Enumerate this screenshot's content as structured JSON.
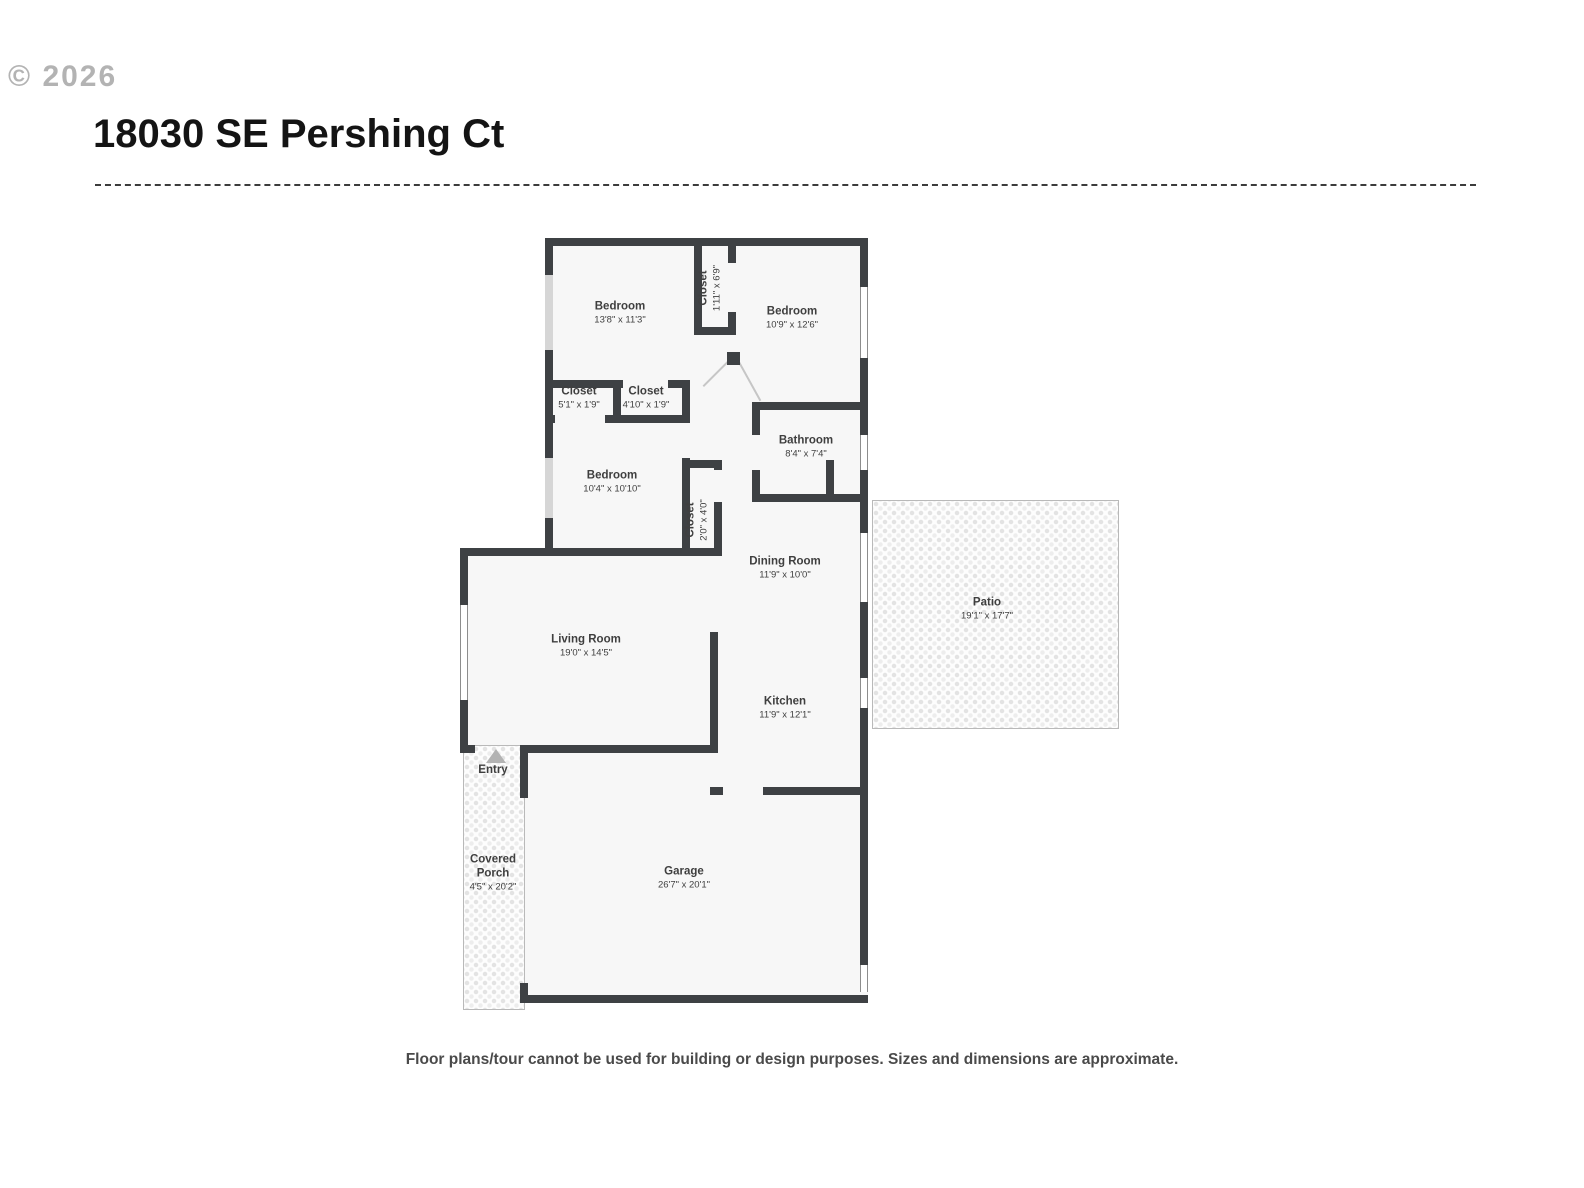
{
  "watermark": "© 2026",
  "header": {
    "title": "18030 SE Pershing Ct"
  },
  "rooms": {
    "bedroom1": {
      "name": "Bedroom",
      "dims": "13'8\" x 11'3\""
    },
    "closet_top": {
      "name": "Closet",
      "dims": "1'11\" x 6'9\""
    },
    "bedroom2": {
      "name": "Bedroom",
      "dims": "10'9\" x 12'6\""
    },
    "closet_left": {
      "name": "Closet",
      "dims": "5'1\" x 1'9\""
    },
    "closet_right": {
      "name": "Closet",
      "dims": "4'10\" x 1'9\""
    },
    "bathroom": {
      "name": "Bathroom",
      "dims": "8'4\" x 7'4\""
    },
    "bedroom3": {
      "name": "Bedroom",
      "dims": "10'4\" x 10'10\""
    },
    "closet_hall": {
      "name": "Closet",
      "dims": "2'0\" x 4'0\""
    },
    "dining": {
      "name": "Dining Room",
      "dims": "11'9\" x 10'0\""
    },
    "patio": {
      "name": "Patio",
      "dims": "19'1\" x 17'7\""
    },
    "living": {
      "name": "Living Room",
      "dims": "19'0\" x 14'5\""
    },
    "kitchen": {
      "name": "Kitchen",
      "dims": "11'9\" x 12'1\""
    },
    "entry": {
      "name": "Entry"
    },
    "porch": {
      "name_line1": "Covered",
      "name_line2": "Porch",
      "dims": "4'5\" x 20'2\""
    },
    "garage": {
      "name": "Garage",
      "dims": "26'7\" x 20'1\""
    }
  },
  "footer": {
    "disclaimer": "Floor plans/tour cannot be used for building or design purposes. Sizes and dimensions are approximate."
  },
  "colors": {
    "wall": "#3e4144",
    "room_fill": "#f7f7f7",
    "window_gray": "#d6d6d6",
    "accent_text": "#3f3f3f"
  }
}
